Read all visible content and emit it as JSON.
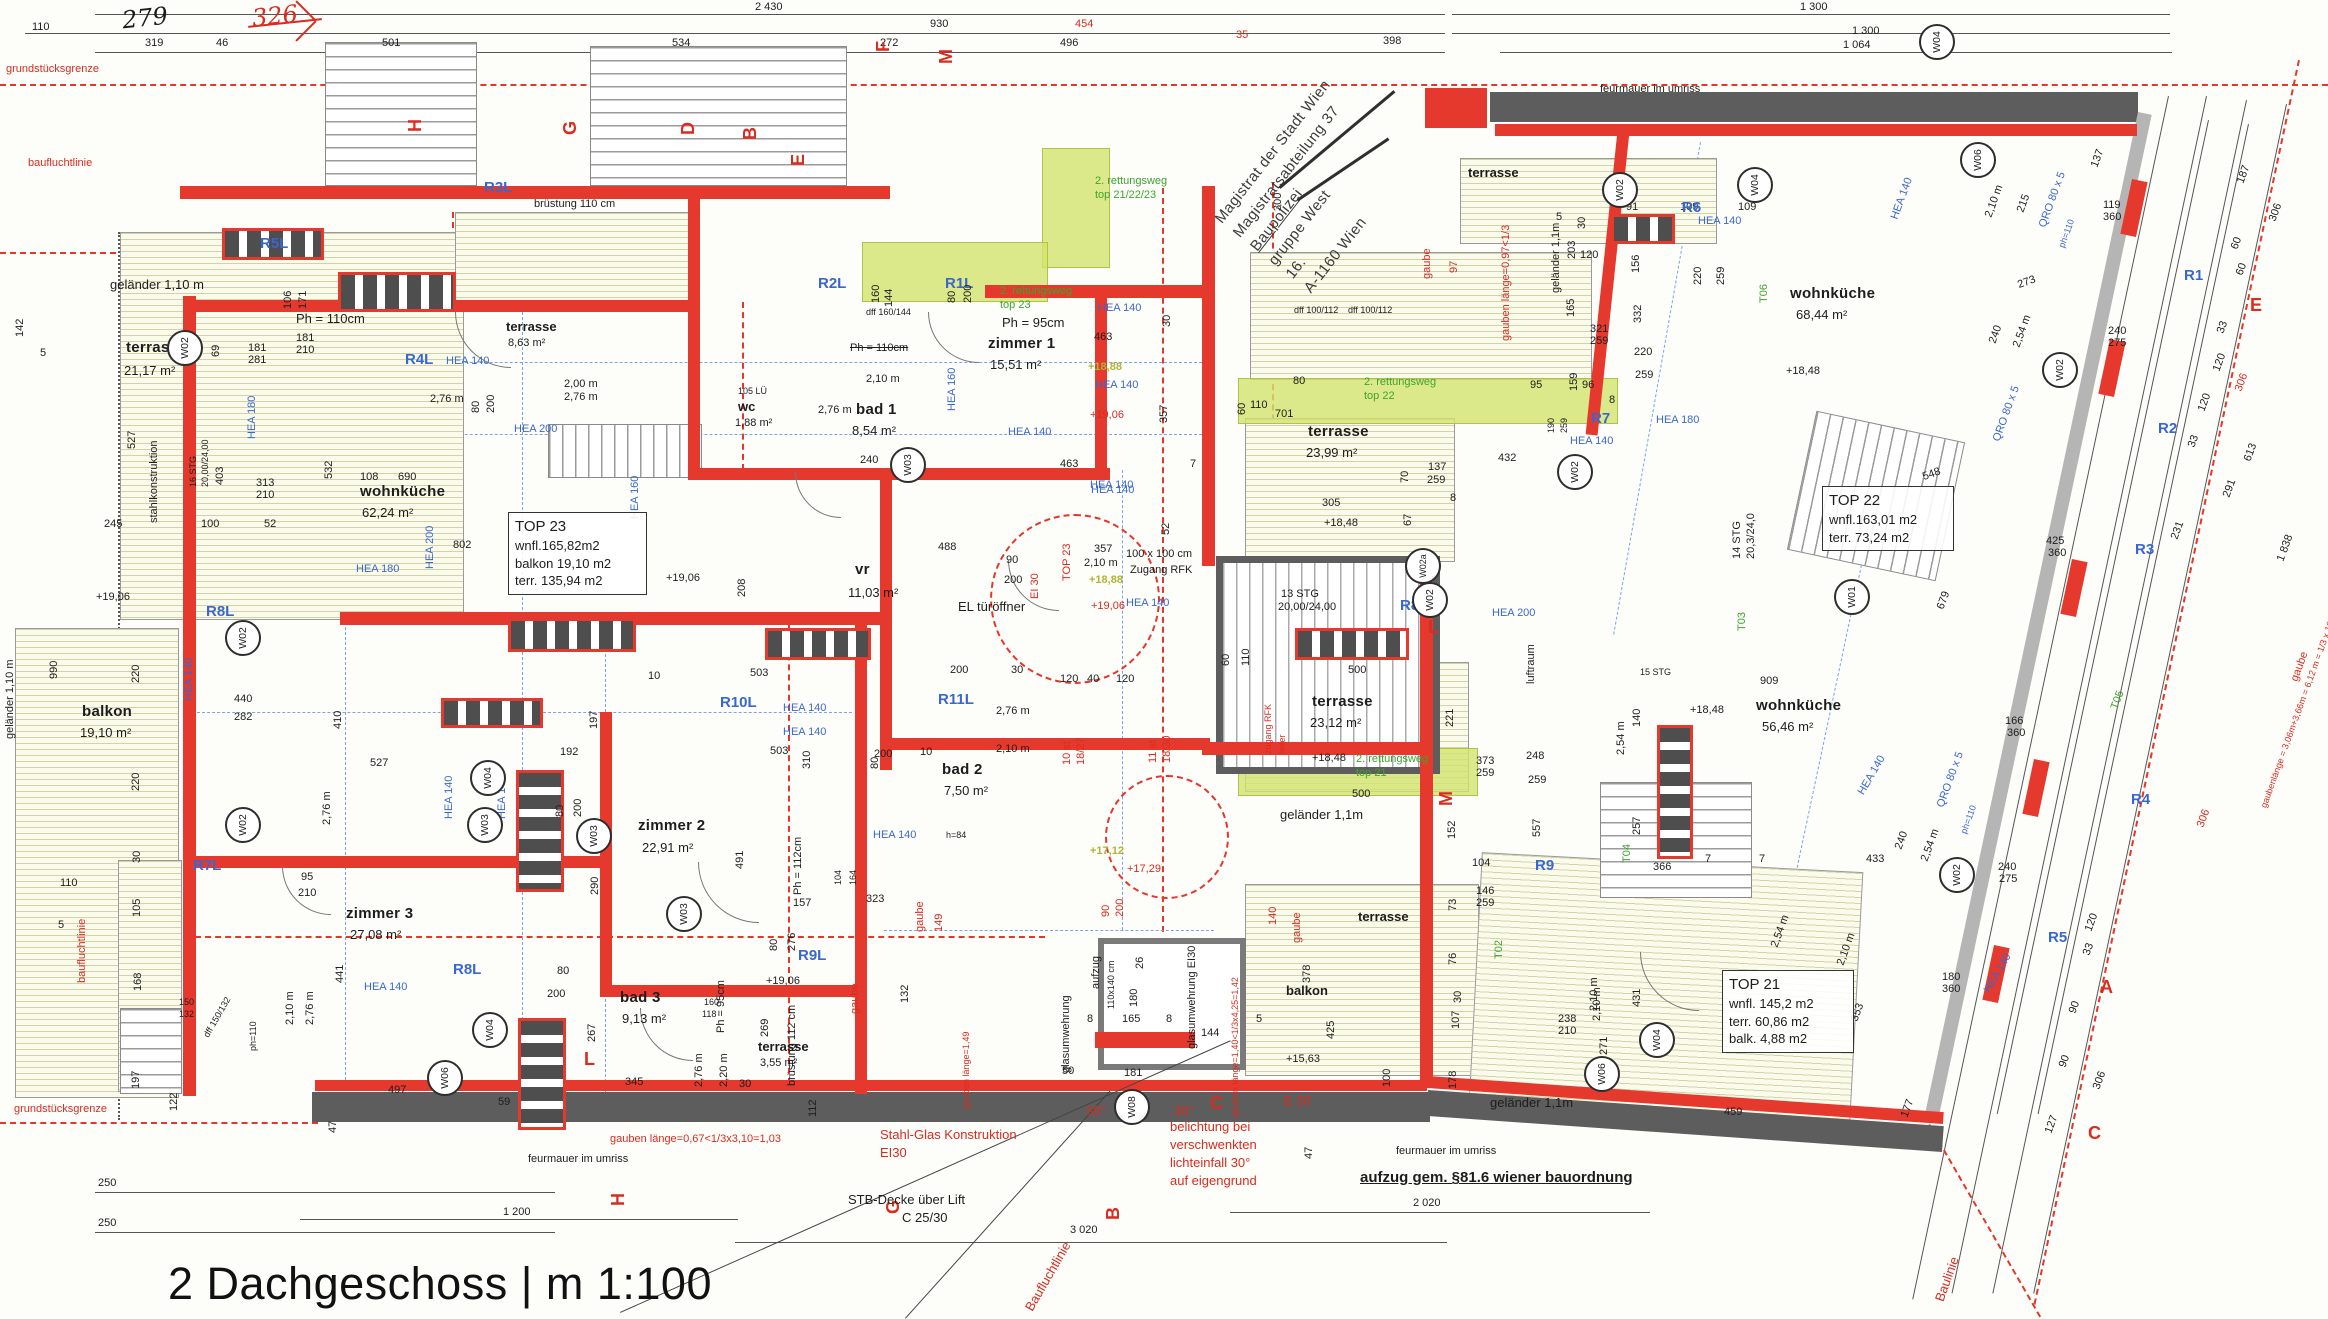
{
  "title": "2 Dachgeschoss | m 1:100",
  "stamp": {
    "l1": "Magistrat der Stadt Wien",
    "l2": "Magistratsabteilung 37",
    "l3": "Baupolizei",
    "l4": "gruppe West",
    "l5": "16.",
    "l6": "A-1160 Wien"
  },
  "boxes": [
    {
      "l1": "TOP 23",
      "l2": "wnfl.165,82m2",
      "l3": "balkon 19,10 m2",
      "l4": "terr. 135,94 m2"
    },
    {
      "l1": "TOP 22",
      "l2": "wnfl.163,01 m2",
      "l3": "terr.  73,24 m2",
      "l4": ""
    },
    {
      "l1": "TOP 21",
      "l2": "wnfl. 145,2 m2",
      "l3": "terr.  60,86 m2",
      "l4": "balk.  4,88 m2"
    }
  ],
  "circles": [
    "W02",
    "W03",
    "W02",
    "W02",
    "W03",
    "W04",
    "W03",
    "W03",
    "W04",
    "W06",
    "W08",
    "W02",
    "W04",
    "W04",
    "W02",
    "W02a",
    "W02",
    "W01",
    "W06",
    "W02",
    "W02",
    "W04",
    "W06"
  ],
  "labels": [
    "grundstücksgrenze",
    "baufluchtlinie",
    "2 430",
    "1 300",
    "110",
    "279",
    "326",
    "930",
    "454",
    "1 300",
    "319",
    "46",
    "501",
    "534",
    "272",
    "496",
    "35",
    "398",
    "1 064",
    "feurmauer im umriss",
    "terrasse",
    "5",
    "203",
    "91",
    "109",
    "109",
    "156",
    "R6",
    "HEA 140",
    "geländer 1,1m",
    "30",
    "120",
    "165",
    "321",
    "259",
    "159",
    "220",
    "259",
    "220",
    "259",
    "332",
    "T06",
    "dff 100/112",
    "dff 100/112",
    "300",
    "gaube",
    "97",
    "gauben länge=0,97<1/3",
    "2. rettungsweg",
    "top 21/22/23",
    "2. rettungsweg",
    "top 23",
    "Ph = 95cm",
    "zimmer 1",
    "15,51 m²",
    "463",
    "30",
    "HEA 140",
    "+18,88",
    "HEA 140",
    "+19,06",
    "HEA 140",
    "463",
    "7",
    "357",
    "52",
    "HEA 140",
    "R2L",
    "R1L",
    "R5L",
    "R3L",
    "dff 160/144",
    "Ph = 110cm",
    "bad 1",
    "8,54 m²",
    "2,10 m",
    "2,76 m",
    "wc",
    "1,88 m²",
    "105 LÜ",
    "240",
    "160",
    "144",
    "106",
    "171",
    "Ph = 110cm",
    "geländer 1,10 m",
    "terrasse",
    "21,17 m²",
    "142",
    "brüstung 110 cm",
    "terrasse",
    "8,63 m²",
    "2,00 m",
    "2,76 m",
    "2,76 m",
    "HEA 140",
    "R4L",
    "80",
    "200",
    "80",
    "200",
    "HEA 200",
    "HEA 160",
    "HEA 180",
    "stahlkonstruktion",
    "16 STG",
    "20,00/24,00",
    "527",
    "403",
    "313",
    "210",
    "181",
    "281",
    "181",
    "210",
    "69",
    "5",
    "245",
    "100",
    "52",
    "wohnküche",
    "62,24 m²",
    "108",
    "690",
    "532",
    "802",
    "HEA 180",
    "HEA 200",
    "+19,06",
    "208",
    "+19,06",
    "990",
    "geländer 1,10 m",
    "balkon",
    "19,10 m²",
    "220",
    "220",
    "30",
    "R8L",
    "R7L",
    "HEA 140",
    "440",
    "282",
    "410",
    "527",
    "2,76 m",
    "HEA 140",
    "HEA 140",
    "192",
    "197",
    "80",
    "200",
    "290",
    "zimmer 2",
    "22,91 m²",
    "491",
    "Ph = 112cm",
    "157",
    "80",
    "276",
    "R10L",
    "R11L",
    "R9L",
    "HEA 140",
    "HEA 140",
    "503",
    "503",
    "310",
    "10",
    "200",
    "30",
    "120",
    "40",
    "120",
    "zimmer 3",
    "27,08 m²",
    "R8L",
    "HEA 140",
    "441",
    "95",
    "210",
    "2,10 m",
    "2,76 m",
    "dff 150/132",
    "ph=110",
    "150",
    "132",
    "168",
    "197",
    "122",
    "110",
    "105",
    "5",
    "grundstücksgrenze",
    "250",
    "250",
    "1 200",
    "feurmauer im umriss",
    "baufluchtlinie",
    "497",
    "47",
    "59",
    "bad 3",
    "9,13 m²",
    "345",
    "267",
    "80",
    "200",
    "2,76 m",
    "2,20 m",
    "30",
    "160",
    "118",
    "Ph = 95cm",
    "269",
    "terrasse",
    "3,55 m²",
    "112",
    "brüstung 112 cm",
    "+19,06",
    "323",
    "132",
    "104",
    "164",
    "gaube",
    "149",
    "gaube",
    "gauben länge=0,67<1/3x3,10=1,03",
    "H",
    "G",
    "L",
    "Stahl-Glas Konstruktion",
    "EI30",
    "STB-Decke über Lift",
    "C 25/30",
    "3 020",
    "belichtung bei",
    "verschwenkten",
    "lichteinfall 30°",
    "auf eigengrund",
    "30°",
    "30°",
    "B",
    "C",
    "glasumwehrung",
    "glasumwehrung EI30",
    "aufzug",
    "110x140 cm",
    "165",
    "180",
    "26",
    "8",
    "8",
    "144",
    "50",
    "181",
    "5",
    "90",
    "200",
    "+17,12",
    "+17,29",
    "10 st",
    "18/27",
    "11 st",
    "18/30",
    "TOP 23",
    "EI 30",
    "357",
    "2,10 m",
    "100 x 100 cm",
    "Zugang RFK",
    "+18,88",
    "+19,06",
    "HEA 140",
    "13 STG",
    "20,00/24,00",
    "60",
    "110",
    "488",
    "90",
    "200",
    "EL türöffner",
    "vr",
    "11,03 m²",
    "HEA 140",
    "HEA 160",
    "bad 2",
    "7,50 m²",
    "2,76 m",
    "2,10 m",
    "80",
    "200",
    "h=84",
    "HEA 140",
    "10",
    "terrasse",
    "23,99 m²",
    "305",
    "+18,48",
    "110",
    "701",
    "80",
    "60",
    "2. rettungsweg",
    "top 22",
    "95",
    "96",
    "8",
    "190",
    "259",
    "R7",
    "HEA 180",
    "HEA 140",
    "432",
    "70",
    "137",
    "259",
    "67",
    "8",
    "+18,48",
    "terrasse",
    "23,12 m²",
    "2. rettungsweg",
    "top 21",
    "M",
    "373",
    "259",
    "248",
    "259",
    "557",
    "152",
    "221",
    "500",
    "500",
    "geländer 1,1m",
    "104",
    "luftraum",
    "HEA 200",
    "R8",
    "14 STG",
    "20,3/24,0",
    "T03",
    "909",
    "140",
    "+18,48",
    "wohnküche",
    "56,46 m²",
    "15 STG",
    "2,54 m",
    "257",
    "T04",
    "366",
    "7",
    "7",
    "433",
    "240",
    "2,54 m",
    "240",
    "275",
    "166",
    "360",
    "QRO 80 x 5",
    "HEA 140",
    "HEA 140",
    "R5",
    "180",
    "360",
    "353",
    "2,10 m",
    "2,54 m",
    "431",
    "271",
    "2,10 m",
    "459",
    "177",
    "127",
    "90",
    "90",
    "306",
    "120",
    "33",
    "Baulinie",
    "Baufluchtlinie",
    "aufzug gem. §81.6 wiener bauordnung",
    "2 020",
    "geländer 1,1m",
    "terrasse",
    "feurmauer im umriss",
    "balkon",
    "425",
    "+15,63",
    "E 30",
    "47",
    "100",
    "140",
    "gaube",
    "gauben länge=1,40<1/3x4,25=1,42",
    "gauben länge=1,49",
    "378",
    "73",
    "76",
    "146",
    "259",
    "107",
    "30",
    "178",
    "238",
    "210",
    "2,10 m",
    "T02",
    "R9",
    "zugang RFK",
    "leiter",
    "wohnküche",
    "68,44 m²",
    "+18,48",
    "HEA 140",
    "2,10 m",
    "215",
    "273",
    "240",
    "2,54 m",
    "137",
    "119",
    "360",
    "240",
    "275",
    "425",
    "360",
    "679",
    "548",
    "E",
    "R1",
    "R2",
    "R3",
    "R4",
    "T05",
    "187",
    "306",
    "60",
    "60",
    "33",
    "120",
    "120",
    "33",
    "231",
    "613",
    "291",
    "1 838",
    "306",
    "306",
    "gaube",
    "gaubenlänge = 3,06m+3,66m = 6,12 m = 1/3 x 18,36=6,13 m",
    "H",
    "G",
    "D",
    "B",
    "E",
    "F",
    "M",
    "A",
    "C",
    "L",
    "QRO 80 x 5",
    "ph=110",
    "QRO 80 x 5",
    "ph=110"
  ]
}
